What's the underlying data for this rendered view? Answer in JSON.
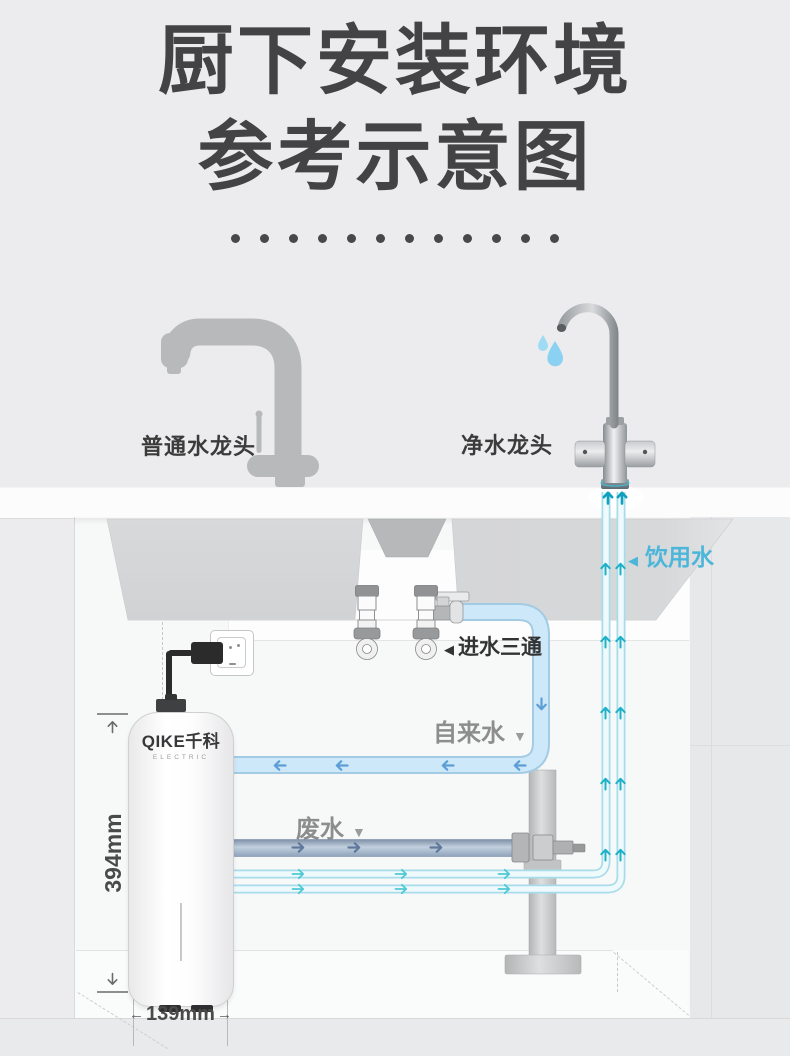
{
  "title": {
    "line1": "厨下安装环境",
    "line2": "参考示意图"
  },
  "separator": {
    "dot_count": 12
  },
  "faucets": {
    "normal_label": "普通水龙头",
    "purified_label": "净水龙头"
  },
  "annotations": {
    "drinking": {
      "marker": "◀",
      "label": "饮用水",
      "color": "#4cb6da"
    },
    "inlet_tee": {
      "marker": "◀",
      "label": "进水三通"
    },
    "tap": {
      "label": "自来水",
      "marker": "▼"
    },
    "waste": {
      "label": "废水",
      "marker": "▼"
    }
  },
  "purifier": {
    "brand": "QIKE千科",
    "subbrand": "ELECTRIC"
  },
  "dimensions": {
    "height": "394mm",
    "width": "139mm",
    "arrow_left": "←",
    "arrow_right": "→"
  },
  "colors": {
    "background": "#ececee",
    "title_text": "#434345",
    "tap_pipe": "#cde8f8",
    "waste_pipe": "#a9bcd0",
    "drinking_pipe": "#eefafc",
    "flow_arrow_teal": "#1db0c6",
    "flow_arrow_blue": "#5c9fd6",
    "label_gray": "#8d8d8e",
    "label_cyan": "#4cb6da",
    "text_dark": "#3b3b3b"
  }
}
